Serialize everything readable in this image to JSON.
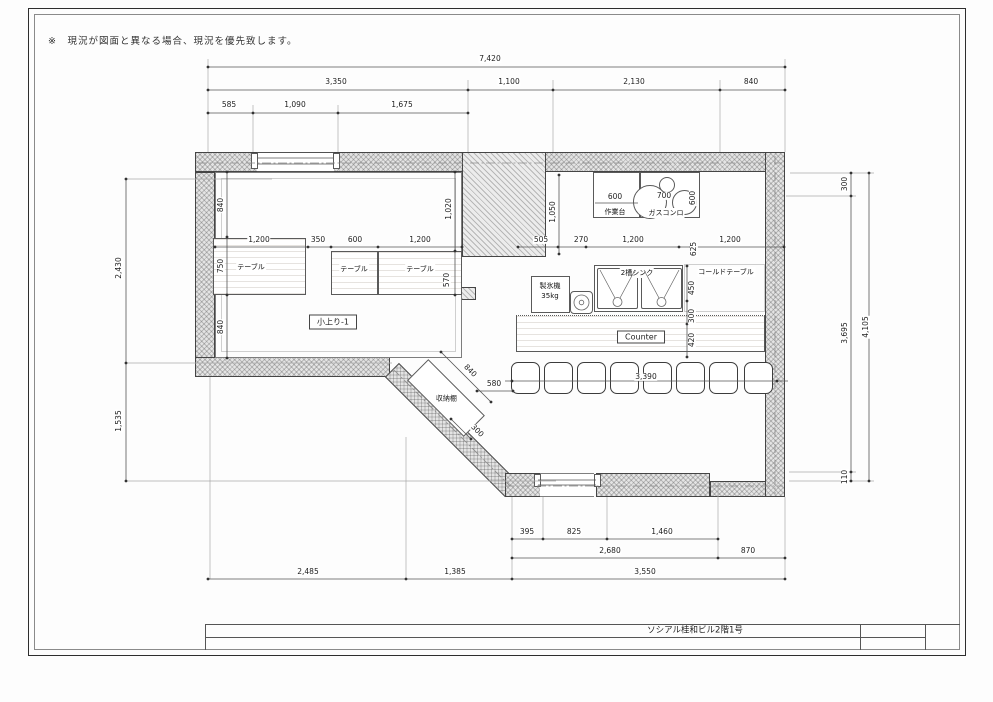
{
  "note": "※　現況が図面と異なる場合、現況を優先致します。",
  "title_block": {
    "label": "ソシアル桂和ビル2階1号"
  },
  "dims": {
    "top1": [
      "7,420"
    ],
    "top2": [
      "3,350",
      "1,100",
      "2,130",
      "840"
    ],
    "top3": [
      "585",
      "1,090",
      "1,675"
    ],
    "left": [
      "2,430",
      "1,535"
    ],
    "right": [
      "300",
      "3,695",
      "4,105",
      "110"
    ],
    "bottom1": [
      "395",
      "825",
      "1,460"
    ],
    "bottom2": [
      "2,680",
      "870"
    ],
    "bottom3": [
      "2,485",
      "1,385",
      "3,550"
    ],
    "room": {
      "left_v": [
        "840",
        "750",
        "840"
      ],
      "right_v": [
        "1,020",
        "570"
      ],
      "table_row": [
        "1,200",
        "350",
        "600",
        "1,200"
      ]
    },
    "kitchen": {
      "back_depth": "1,050",
      "worktable_w": "600",
      "stove_w": "700",
      "stove_d": "600",
      "mid_row": [
        "505",
        "270",
        "1,200",
        "625",
        "1,200"
      ],
      "front_v": [
        "450",
        "300",
        "420"
      ],
      "stool_row": "3,390"
    },
    "storage": {
      "length": "840",
      "offset": "580",
      "depth": "300"
    }
  },
  "labels": {
    "table": "テーブル",
    "room1": "小上り-1",
    "worktable": "作業台",
    "gas_stove": "ガスコンロ",
    "sink": "2槽シンク",
    "cold_table": "コールドテーブル",
    "ice_maker": "製氷機",
    "ice_maker_capacity": "35kg",
    "counter": "Counter",
    "storage": "収納棚"
  }
}
